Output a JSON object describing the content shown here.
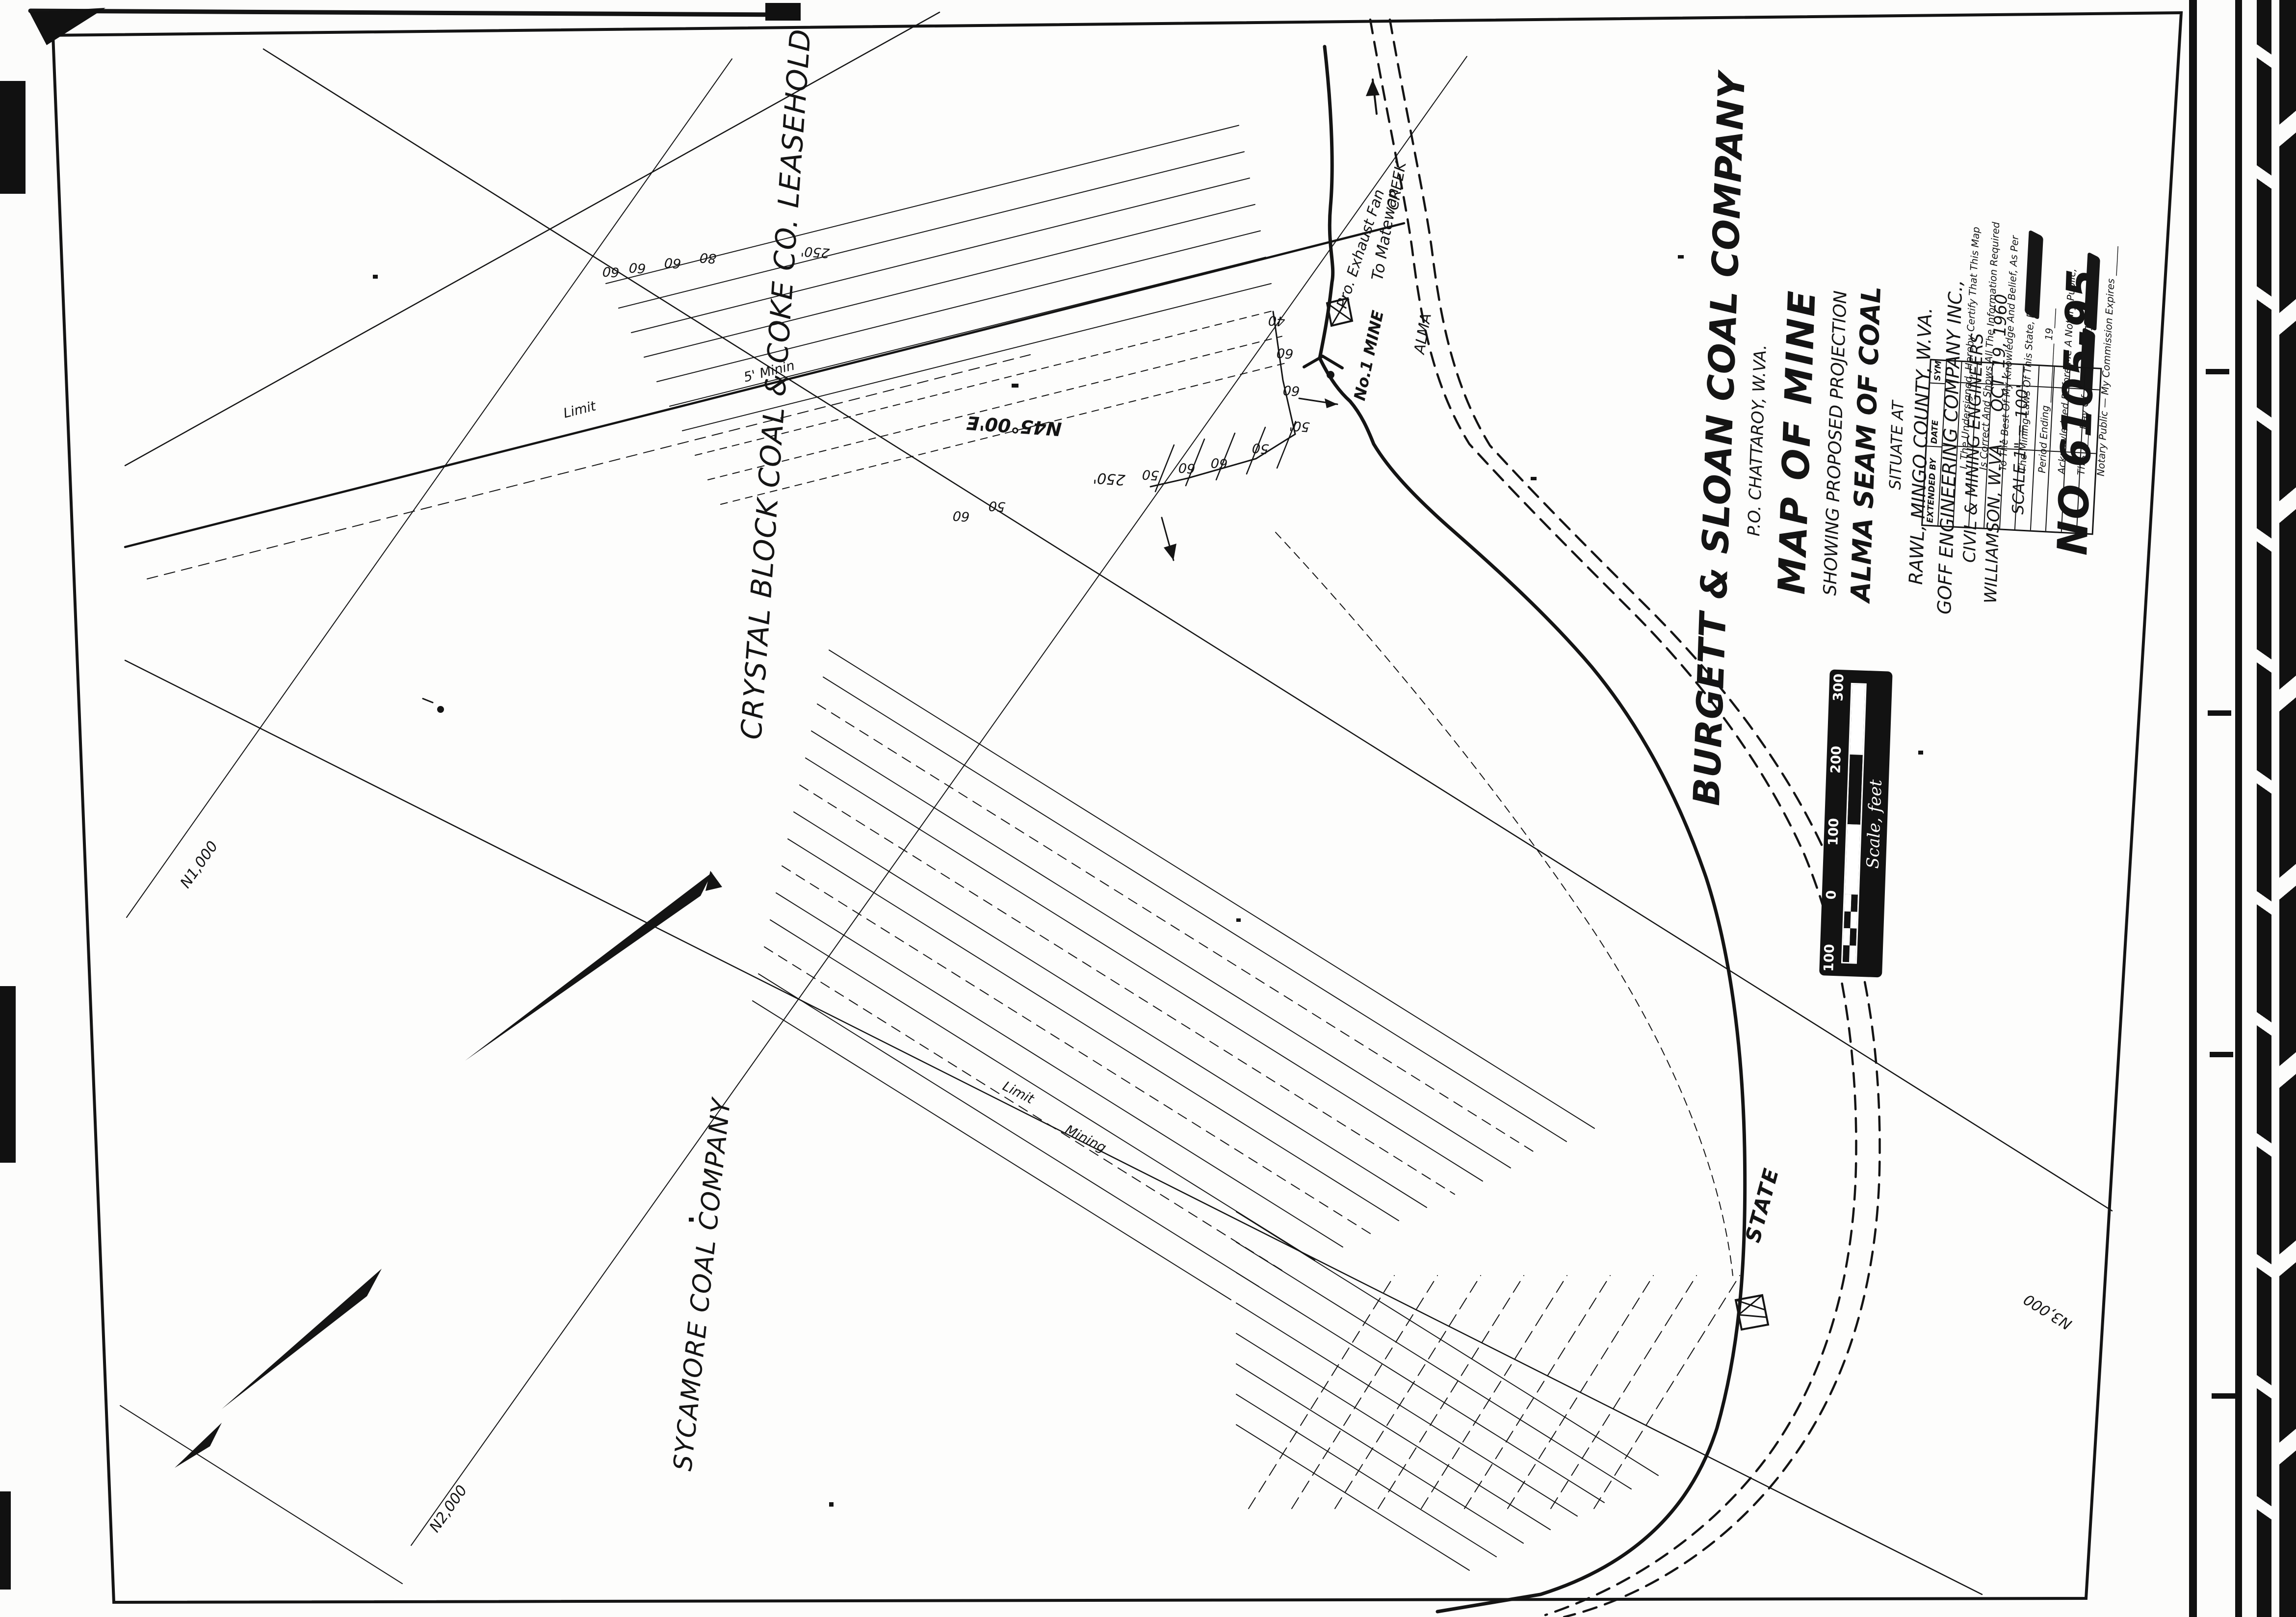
{
  "title_block": {
    "company": "BURGETT & SLOAN COAL COMPANY",
    "address": "P.O. CHATTAROY, W.VA.",
    "map_title": "MAP OF MINE",
    "subtitle": "SHOWING PROPOSED PROJECTION",
    "seam": "ALMA SEAM OF COAL",
    "situate": "SITUATE AT",
    "location": "RAWL, MINGO COUNTY, W.VA.",
    "firm": "GOFF ENGINEERING COMPANY INC.,",
    "firm_role": "CIVIL & MINING ENGINEERS",
    "firm_city": "WILLIAMSON, W.VA.",
    "date": "OCT. 19, 1960",
    "scale": "SCALE 1\" = 100'",
    "drawing_no": "NO 6105-95"
  },
  "certification": {
    "lines": [
      "I, The Undersigned, Hereby Certify That This Map",
      "Is Correct And Shows All The Information Required",
      "To The Best Of My Knowledge And Belief, As Per",
      "The Mining Laws Of This State, For The",
      "Period Ending ____________ 19____",
      "Acknowledged Before Me A Notary Public,",
      "This ____ Day Of ____________ 19____",
      "Notary Public — My Commission Expires ______"
    ]
  },
  "revision_table": {
    "headers": [
      "EXTENDED BY",
      "DATE",
      "SYM"
    ]
  },
  "scale_bar": {
    "label": "Scale, feet",
    "ticks": [
      "100",
      "0",
      "100",
      "200",
      "300"
    ]
  },
  "map_labels": {
    "leasehold": "CRYSTAL BLOCK COAL & COKE CO. LEASEHOLD",
    "neighbor": "SYCAMORE COAL COMPANY",
    "mine": "No.1 MINE",
    "fan": "Pro. Exhaust Fan",
    "road_dest": "To Matewan",
    "road": "STATE",
    "stream1": "ALMA",
    "stream2": "CREEK",
    "bearing": "N45°00'E",
    "dist_a": "250'",
    "dist_b": "250'",
    "limit_a1": "Limit",
    "limit_a2": "5' Minin",
    "limit_b1": "Limit",
    "limit_b2": "Mining"
  },
  "grid_labels": [
    "N1,000",
    "N2,000",
    "N3,000"
  ],
  "pillar_numbers": {
    "g1": [
      "60",
      "60",
      "60",
      "80"
    ],
    "g2": [
      "40",
      "60",
      "60",
      "50'",
      "50",
      "60",
      "60",
      "50"
    ],
    "g3": [
      "50",
      "60"
    ]
  }
}
